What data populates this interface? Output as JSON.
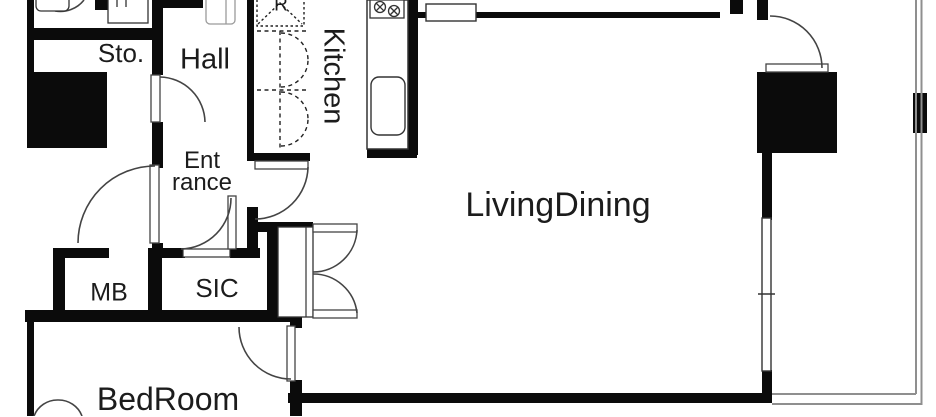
{
  "floor_plan": {
    "rooms": [
      {
        "name": "storage",
        "label": "Sto."
      },
      {
        "name": "hall",
        "label": "Hall"
      },
      {
        "name": "kitchen",
        "label": "Kitchen",
        "orientation": "vertical"
      },
      {
        "name": "entrance",
        "label_line1": "Ent",
        "label_line2": "rance"
      },
      {
        "name": "living-dining",
        "label": "LivingDining"
      },
      {
        "name": "meter-box",
        "label": "MB"
      },
      {
        "name": "shoe-in-closet",
        "label": "SIC"
      },
      {
        "name": "bedroom",
        "label": "BedRoom"
      },
      {
        "name": "refrigerator-space",
        "label": "R"
      }
    ],
    "colors": {
      "wall": "#0b0b0b",
      "background": "#ffffff",
      "door_swing": "#444444",
      "balcony_rail": "#8f8f8f",
      "fixture_outline": "#333333"
    },
    "icons": [
      "stove-burners-icon",
      "kitchen-sink-icon",
      "refrigerator-dashed-icon",
      "toilet-icon",
      "washbasin-icon",
      "door-swing-arc-icon"
    ]
  }
}
